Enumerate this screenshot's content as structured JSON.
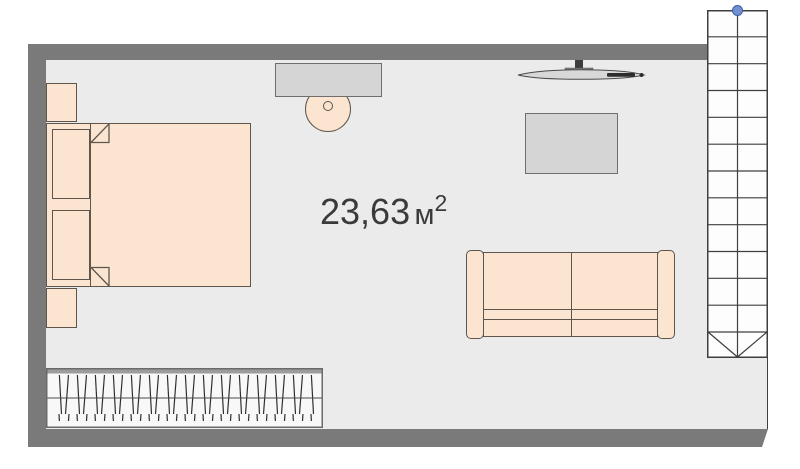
{
  "floorplan": {
    "area_label": {
      "value": "23,63",
      "unit": "м",
      "exponent": "2"
    },
    "items": [
      "bed",
      "nightstand",
      "wardrobe",
      "desk",
      "stool",
      "tv",
      "side-table",
      "sofa",
      "staircase"
    ],
    "colors": {
      "wall": "#7a7a7a",
      "floor": "#ebebeb",
      "peach": "#fce5d0",
      "outline": "#5e564c",
      "surface": "#d5d5d5",
      "surface-border": "#6e6e6e",
      "line": "#3f3f3f",
      "handle": "#7491cf",
      "handle-border": "#3a5ca8",
      "wardrobe-fill": "#f8f8f8",
      "wardrobe-bar": "#9c9c9c"
    }
  }
}
